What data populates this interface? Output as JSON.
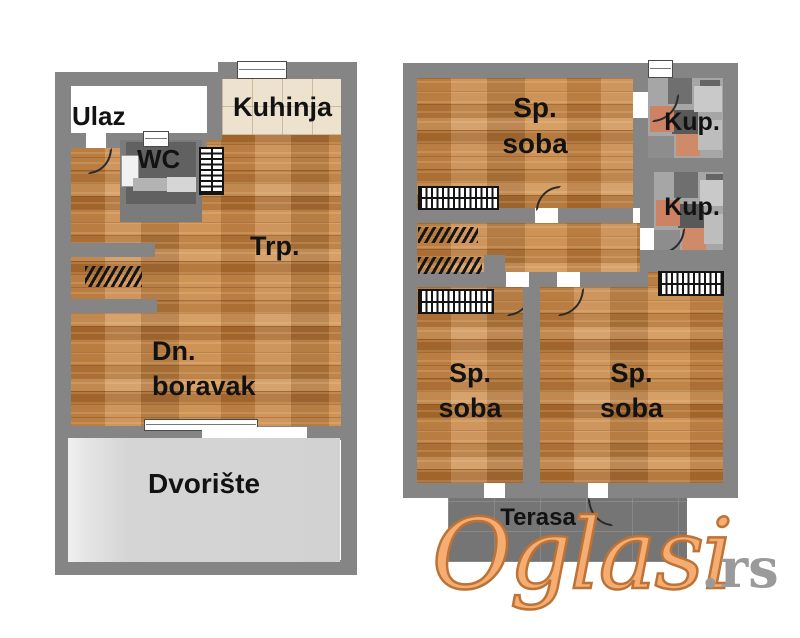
{
  "ground_floor": {
    "entrance": "Ulaz",
    "kitchen": "Kuhinja",
    "wc": "WC",
    "dining": "Trp.",
    "living1": "Dn.",
    "living2": "boravak",
    "yard": "Dvorište"
  },
  "upper_floor": {
    "bed_top1": "Sp.",
    "bed_top2": "soba",
    "bath1": "Kup.",
    "bath2": "Kup.",
    "bed_left1": "Sp.",
    "bed_left2": "soba",
    "bed_right1": "Sp.",
    "bed_right2": "soba",
    "terrace": "Terasa"
  },
  "watermark": {
    "brand": "Oglasi",
    "suffix": ".rs"
  },
  "colors": {
    "wall": "#858585",
    "wood": "#c6884a",
    "kitchen_tile": "#ece2cd",
    "wc": "#616161",
    "yard": "#d5d5d5",
    "terrace": "#7b7b7b",
    "bath_tile_accent": "#ce8264",
    "watermark_orange": "#f6ad72",
    "watermark_gray": "#9a9a9a"
  }
}
